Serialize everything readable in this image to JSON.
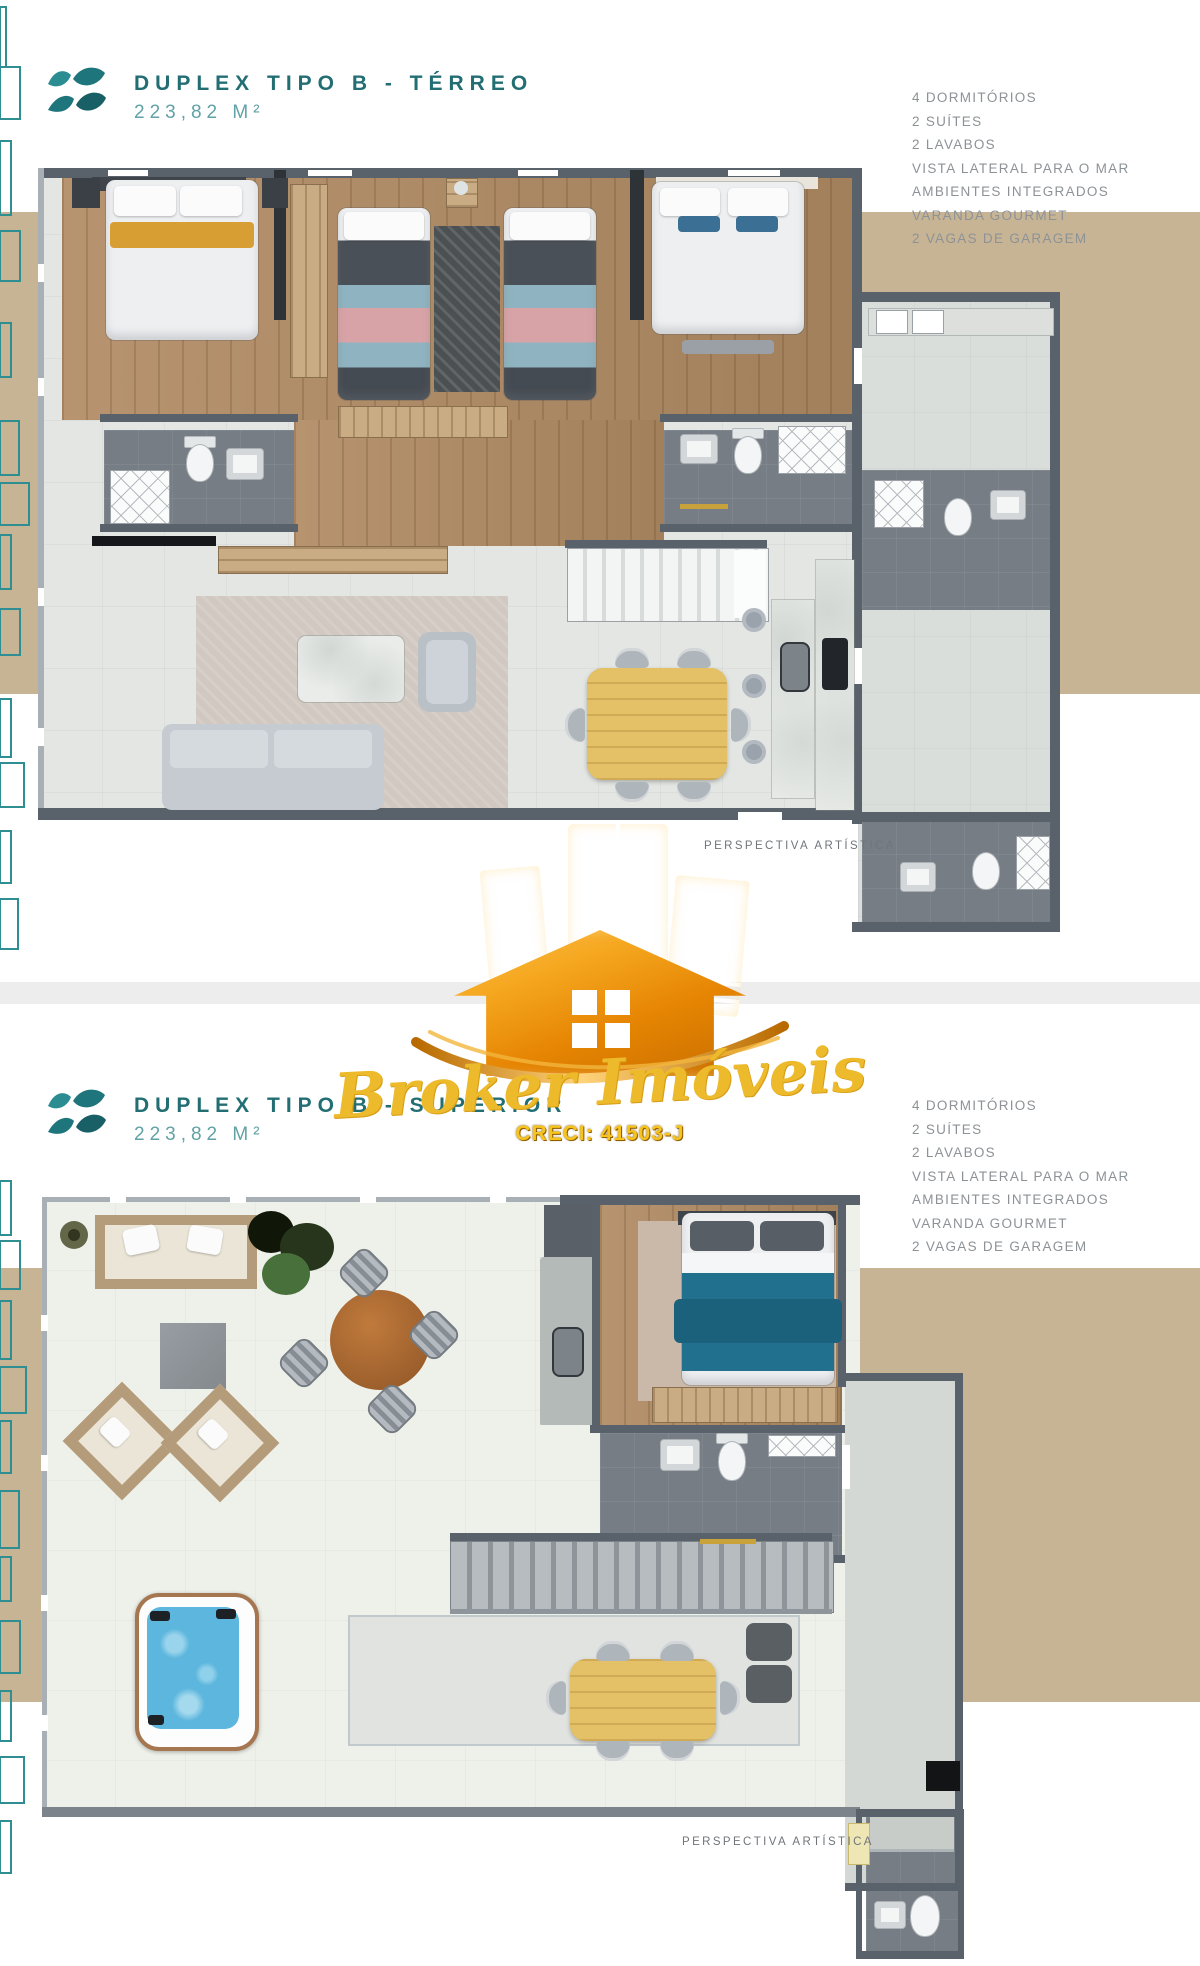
{
  "sections": [
    {
      "title": "DUPLEX TIPO B - TÉRREO",
      "area": "223,82 M²",
      "caption": "PERSPECTIVA ARTÍSTICA",
      "features": [
        "4 DORMITÓRIOS",
        "2 SUÍTES",
        "2 LAVABOS",
        "VISTA LATERAL PARA O MAR",
        "AMBIENTES INTEGRADOS",
        "VARANDA GOURMET",
        "2 VAGAS DE GARAGEM"
      ]
    },
    {
      "title": "DUPLEX TIPO B - SUPERIOR",
      "area": "223,82 M²",
      "caption": "PERSPECTIVA ARTÍSTICA",
      "features": [
        "4 DORMITÓRIOS",
        "2 SUÍTES",
        "2 LAVABOS",
        "VISTA LATERAL PARA O MAR",
        "AMBIENTES INTEGRADOS",
        "VARANDA GOURMET",
        "2 VAGAS DE GARAGEM"
      ]
    }
  ],
  "watermark": {
    "brand": "Broker Imóveis",
    "creci": "CRECI: 41503-J"
  },
  "icons": {
    "brand_logo": "wave-logo",
    "watermark_logo": "gold-buildings-house"
  },
  "colors": {
    "teal": "#226e73",
    "teal_light": "#61a2a6",
    "text_gray": "#8d9296",
    "beige_band": "#c7b495",
    "gold": "#f0a11c",
    "gold_text": "#ecba2a"
  }
}
